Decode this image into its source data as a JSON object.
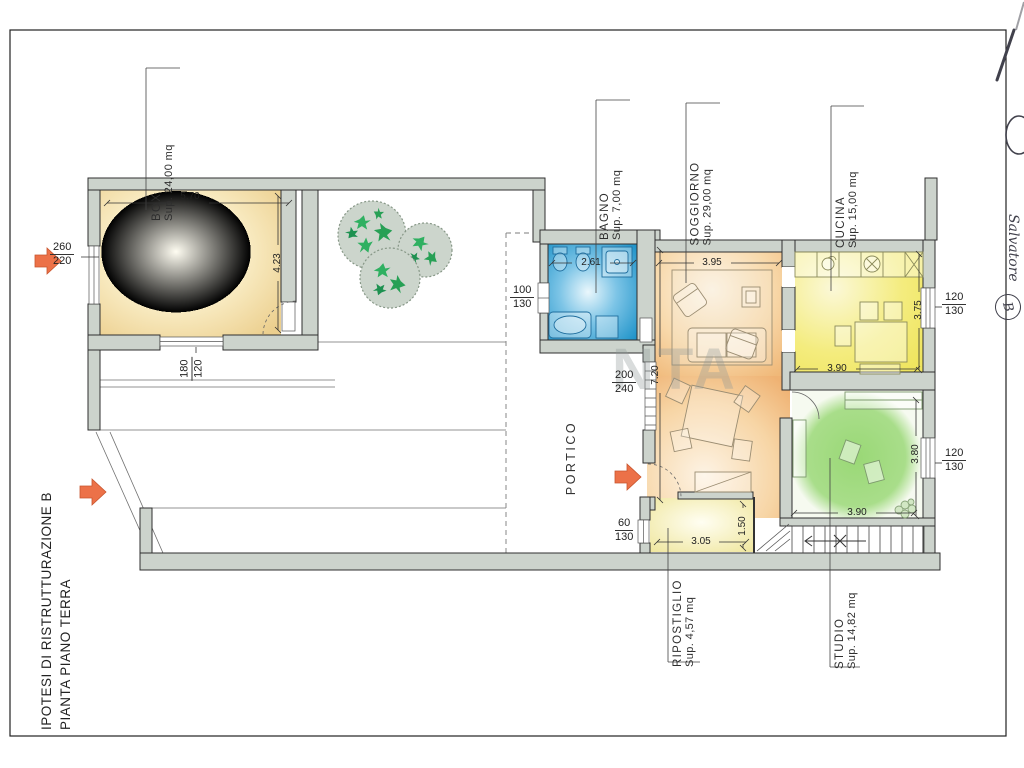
{
  "sheet": {
    "title_line1": "IPOTESI DI RISTRUTTURAZIONE B",
    "title_line2": "PIANTA PIANO TERRA",
    "watermark": "NTA",
    "handwriting_name": "Salvatore",
    "handwriting_letter": "B"
  },
  "rooms": {
    "box": {
      "name": "BOX",
      "area": "Sup. 24,00 mq"
    },
    "bagno": {
      "name": "BAGNO",
      "area": "Sup. 7,00 mq"
    },
    "soggiorno": {
      "name": "SOGGIORNO",
      "area": "Sup. 29,00 mq"
    },
    "cucina": {
      "name": "CUCINA",
      "area": "Sup. 15,00 mq"
    },
    "portico": {
      "name": "PORTICO"
    },
    "ripostiglio": {
      "name": "RIPOSTIGLIO",
      "area": "Sup. 4,57 mq"
    },
    "studio": {
      "name": "STUDIO",
      "area": "Sup. 14,82 mq"
    }
  },
  "dims": {
    "box_width": "5.70",
    "box_depth": "4.23",
    "bagno_width": "2.61",
    "soggiorno_width": "3.95",
    "soggiorno_depth": "7.20",
    "cucina_depth": "3.75",
    "cucina_width": "3.90",
    "studio_depth": "3.80",
    "studio_width": "3.90",
    "ripostiglio_width": "3.05",
    "ripostiglio_depth": "1.50"
  },
  "openings": {
    "garage_door": {
      "w": "260",
      "h": "220"
    },
    "box_door": {
      "w": "180",
      "h": "120"
    },
    "bagno_window": {
      "w": "100",
      "h": "130"
    },
    "soggiorno_door": {
      "w": "200",
      "h": "240"
    },
    "cucina_window": {
      "w": "120",
      "h": "130"
    },
    "studio_window": {
      "w": "120",
      "h": "130"
    },
    "ripostiglio_window": {
      "w": "60",
      "h": "130"
    }
  },
  "colors": {
    "wall": "#ccd3cc",
    "accent_arrow": "#ec7148",
    "box_room": "#f2dfa6",
    "bagno_room": "#2d9fd6",
    "soggiorno_room": "#f2bd7e",
    "cucina_room": "#f1e96a",
    "studio_room": "#86d161",
    "ripostiglio_room": "#f1e9a0"
  }
}
